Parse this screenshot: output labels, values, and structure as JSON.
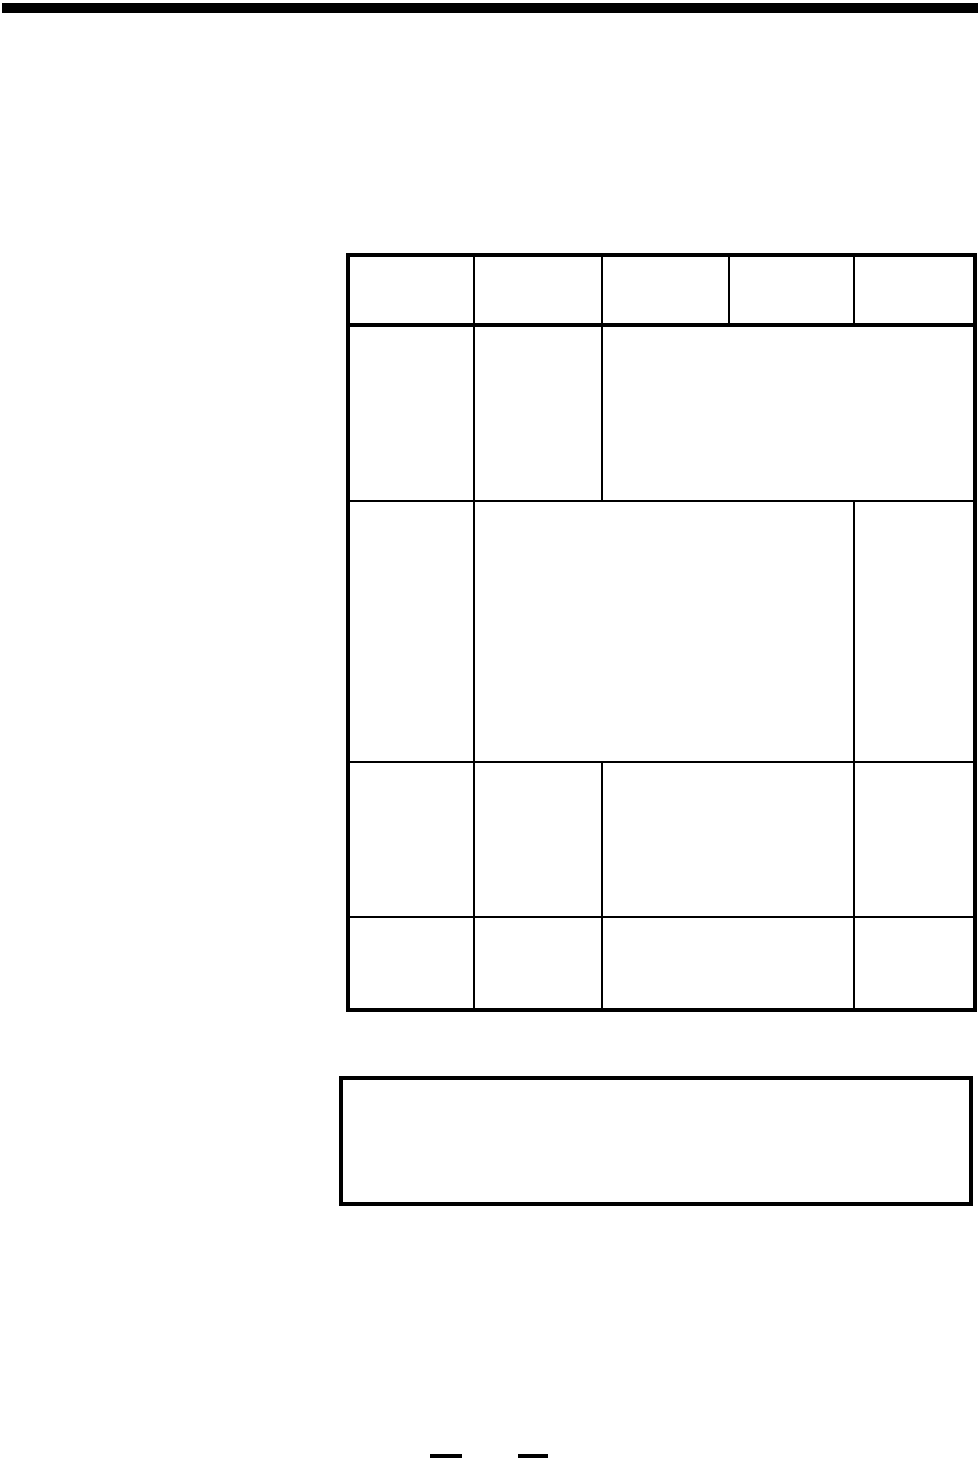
{
  "page": {
    "background": "#ffffff",
    "ink_color": "#000000"
  },
  "top_rule": {
    "present": true
  },
  "table": {
    "column_count": 5,
    "column_widths_px": [
      126,
      128,
      127,
      125,
      121
    ],
    "rows": [
      {
        "name": "header-row",
        "cells": [
          {
            "span": 1,
            "text": ""
          },
          {
            "span": 1,
            "text": ""
          },
          {
            "span": 1,
            "text": ""
          },
          {
            "span": 1,
            "text": ""
          },
          {
            "span": 1,
            "text": ""
          }
        ]
      },
      {
        "name": "body-row-1",
        "cells": [
          {
            "span": 1,
            "text": ""
          },
          {
            "span": 1,
            "text": ""
          },
          {
            "span": 3,
            "text": ""
          }
        ]
      },
      {
        "name": "body-row-2",
        "cells": [
          {
            "span": 1,
            "text": ""
          },
          {
            "span": 3,
            "text": ""
          },
          {
            "span": 1,
            "text": ""
          }
        ]
      },
      {
        "name": "body-row-3",
        "cells": [
          {
            "span": 1,
            "text": ""
          },
          {
            "span": 1,
            "text": ""
          },
          {
            "span": 2,
            "text": ""
          },
          {
            "span": 1,
            "text": ""
          }
        ]
      },
      {
        "name": "body-row-4",
        "cells": [
          {
            "span": 1,
            "text": ""
          },
          {
            "span": 1,
            "text": ""
          },
          {
            "span": 2,
            "text": ""
          },
          {
            "span": 1,
            "text": ""
          }
        ]
      }
    ]
  },
  "note_box": {
    "text": ""
  },
  "footer": {
    "mark_count": 2,
    "marks": [
      {
        "text": ""
      },
      {
        "text": ""
      }
    ]
  }
}
